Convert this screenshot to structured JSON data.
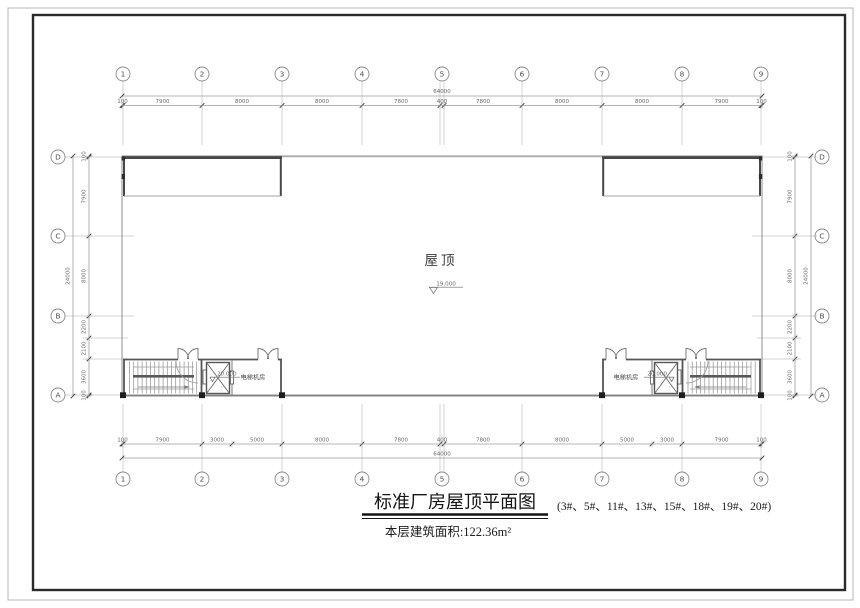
{
  "colors": {
    "line_thin": "#9b9b9b",
    "line_grid": "#c0c0c0",
    "line_wall": "#4a4a4a",
    "tick": "#3f3f3f",
    "text_dark": "#1f1f1f",
    "text_dim": "#6a6a6a"
  },
  "plan": {
    "roof_label": "屋顶",
    "roof_elevation": "19.000",
    "left_unit": {
      "machine_room_label": "电梯机房",
      "elevation": "20.000"
    },
    "right_unit": {
      "machine_room_label": "电梯机房",
      "elevation": "20.000"
    }
  },
  "grid": {
    "cols": [
      {
        "label": "1",
        "mm": 100
      },
      {
        "label": "2",
        "mm": 8000
      },
      {
        "label": "3",
        "mm": 16000
      },
      {
        "label": "4",
        "mm": 24000
      },
      {
        "label": "5",
        "mm": 32000,
        "pair": [
          31800,
          32200
        ]
      },
      {
        "label": "6",
        "mm": 40000
      },
      {
        "label": "7",
        "mm": 48000
      },
      {
        "label": "8",
        "mm": 56000
      },
      {
        "label": "9",
        "mm": 63900
      }
    ],
    "rows": [
      {
        "label": "D",
        "mm": 100
      },
      {
        "label": "C",
        "mm": 8000
      },
      {
        "label": "B",
        "mm": 16000
      },
      {
        "label": "A",
        "mm": 23900
      }
    ],
    "row_subs": [
      18200,
      20300
    ]
  },
  "dims": {
    "top": {
      "overall": "64000",
      "bounds": [
        0,
        100,
        8000,
        16000,
        24000,
        31800,
        32200,
        40000,
        48000,
        56000,
        63900,
        64000
      ],
      "labels": [
        "100",
        "7900",
        "8000",
        "8000",
        "7800",
        "400",
        "7800",
        "8000",
        "8000",
        "7900",
        "100"
      ]
    },
    "bottom": {
      "overall": "64000",
      "bounds": [
        0,
        100,
        8000,
        11000,
        16000,
        24000,
        31800,
        32200,
        40000,
        48000,
        53000,
        56000,
        63900,
        64000
      ],
      "labels": [
        "100",
        "7900",
        "3000",
        "5000",
        "8000",
        "7800",
        "400",
        "7800",
        "8000",
        "5000",
        "3000",
        "7900",
        "100"
      ]
    },
    "left": {
      "overall": "24000",
      "bounds": [
        0,
        100,
        8000,
        16000,
        18200,
        20300,
        23900,
        24000
      ],
      "labels": [
        "100",
        "7900",
        "8000",
        "2200",
        "2100",
        "3600",
        "100"
      ]
    },
    "right": {
      "overall": "24000",
      "bounds": [
        0,
        100,
        8000,
        16000,
        18200,
        20300,
        23900,
        24000
      ],
      "labels": [
        "100",
        "7900",
        "8000",
        "2200",
        "2100",
        "3600",
        "100"
      ]
    }
  },
  "titleblock": {
    "title": "标准厂房屋顶平面图",
    "note": "(3#、5#、11#、13#、15#、18#、19#、20#)",
    "area": "本层建筑面积:122.36m²"
  }
}
